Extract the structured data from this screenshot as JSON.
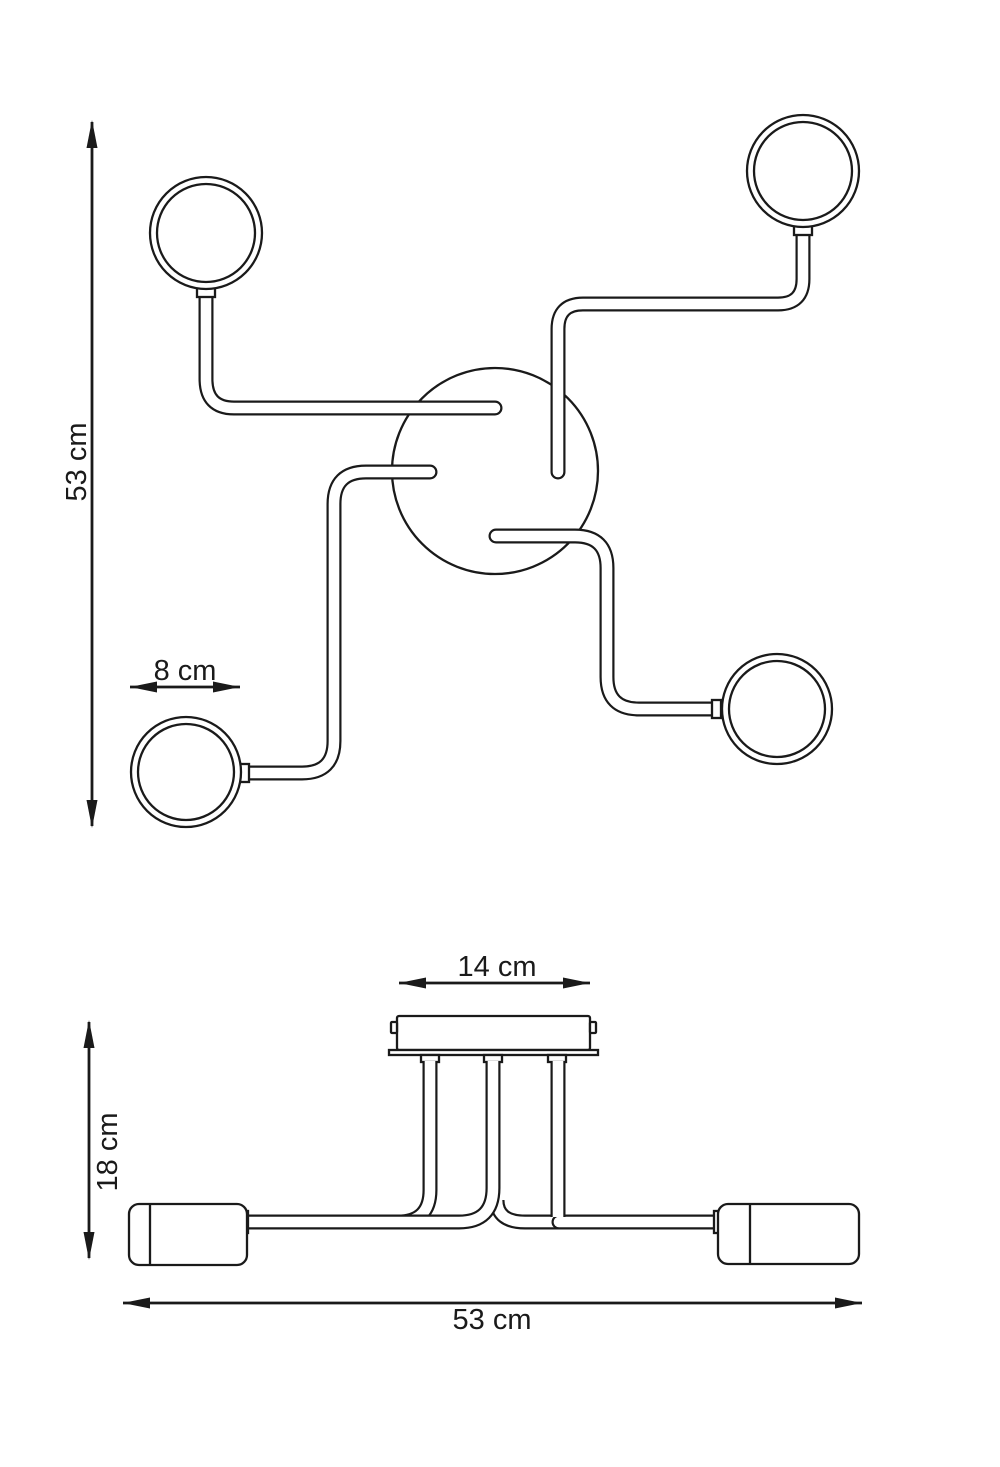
{
  "page": {
    "background": "#ffffff",
    "ink": "#1a1a1a"
  },
  "drawing": {
    "top_view": {
      "dim_total_height": "53 cm",
      "dim_shade_diameter": "8 cm"
    },
    "side_view": {
      "dim_canopy_width": "14 cm",
      "dim_fixture_height": "18 cm",
      "dim_total_width": "53 cm"
    }
  }
}
